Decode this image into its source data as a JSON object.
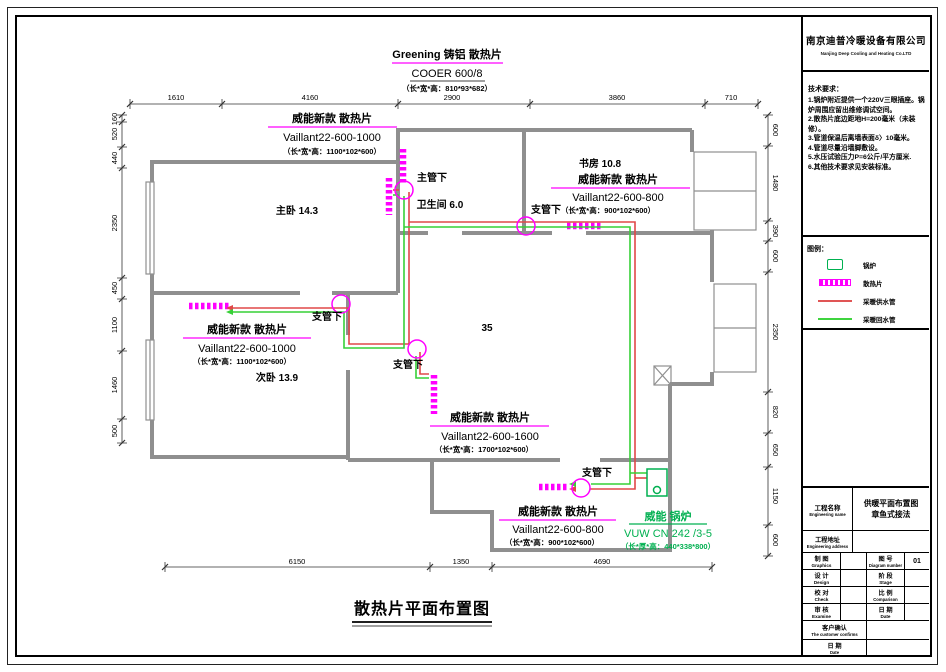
{
  "panel": {
    "company": {
      "name_cn": "南京迪普冷暖设备有限公司",
      "name_en": "Nanjing Deep Cooling and Heating  Co.LTD"
    },
    "tech": {
      "title": "技术要求：",
      "items": [
        "1.锅炉附近提供一个220V三眼插座。锅炉周围应留出维修调试空间。",
        "2.散热片底边距地H=200毫米（未装修）。",
        "3.管道保温后离墙表面δ〉10毫米。",
        "4.管道尽量沿墙脚敷设。",
        "5.水压试验压力P=6公斤/平方厘米.",
        "6.其他技术要求见安装标准。"
      ]
    },
    "legend": {
      "title": "图例：",
      "boiler": "锅炉",
      "radiator": "散热片",
      "supply": "采暖供水管",
      "return_pipe": "采暖回水管"
    },
    "titleblock": {
      "project_label_cn": "工程名称",
      "project_label_en": "Engineering name",
      "project_value_1": "供暖平面布置图",
      "project_value_2": "章鱼式接法",
      "address_label_cn": "工程地址",
      "address_label_en": "Engineering address",
      "rows": [
        {
          "l_cn": "制 图",
          "l_en": "Graphics",
          "r_cn": "图 号",
          "r_en": "Diagram number",
          "r_val": "01"
        },
        {
          "l_cn": "设 计",
          "l_en": "Design",
          "r_cn": "阶 段",
          "r_en": "Stage",
          "r_val": ""
        },
        {
          "l_cn": "校 对",
          "l_en": "Check",
          "r_cn": "比 例",
          "r_en": "Comparison",
          "r_val": ""
        },
        {
          "l_cn": "审 核",
          "l_en": "Examine",
          "r_cn": "日 期",
          "r_en": "Date",
          "r_val": ""
        }
      ],
      "confirm_cn": "客户确认",
      "confirm_en": "The customer confirms",
      "date_cn": "日 期",
      "date_en": "Date"
    }
  },
  "plan": {
    "header": {
      "brand": "Greening 铸铝 散热片",
      "model": "COOER 600/8",
      "dims": "（长*宽*高：810*93*682）"
    },
    "radiators": {
      "tl": {
        "name": "威能新款 散热片",
        "model": "Vaillant22-600-1000",
        "dims": "（长*宽*高：1100*102*600）"
      },
      "study": {
        "name": "威能新款 散热片",
        "model": "Vaillant22-600-800",
        "dims": "（长*宽*高：900*102*600）"
      },
      "ml": {
        "name": "威能新款 散热片",
        "model": "Vaillant22-600-1000",
        "dims": "（长*宽*高：1100*102*600）"
      },
      "cb": {
        "name": "威能新款 散热片",
        "model": "Vaillant22-600-1600",
        "dims": "（长*宽*高：1700*102*600）"
      },
      "bottom": {
        "name": "威能新款 散热片",
        "model": "Vaillant22-600-800",
        "dims": "（长*宽*高：900*102*600）"
      }
    },
    "boiler": {
      "name": "威能 锅炉",
      "model": "VUW CN 242 /3-5",
      "dims": "（长*厚*高：440*338*800）"
    },
    "rooms": {
      "master": "主卧 14.3",
      "bath": "卫生间 6.0",
      "study": "书房 10.8",
      "second": "次卧 13.9",
      "living": "35"
    },
    "pipes": {
      "main": "主管下",
      "branch": "支管下"
    },
    "dims": {
      "top": [
        "1610",
        "4160",
        "2900",
        "3860",
        "710"
      ],
      "bottom": [
        "6150",
        "1350",
        "4690"
      ],
      "left": [
        "160",
        "520",
        "440",
        "2350",
        "450",
        "1100",
        "1460",
        "500"
      ],
      "right": [
        "600",
        "1480",
        "390",
        "600",
        "2350",
        "820",
        "650",
        "1150",
        "600"
      ]
    },
    "title": "散热片平面布置图"
  },
  "colors": {
    "radiator": "#ff00ff",
    "supply_pipe": "#e04848",
    "return_pipe": "#37d037",
    "boiler": "#00b050",
    "wall": "#8f8f8f"
  }
}
